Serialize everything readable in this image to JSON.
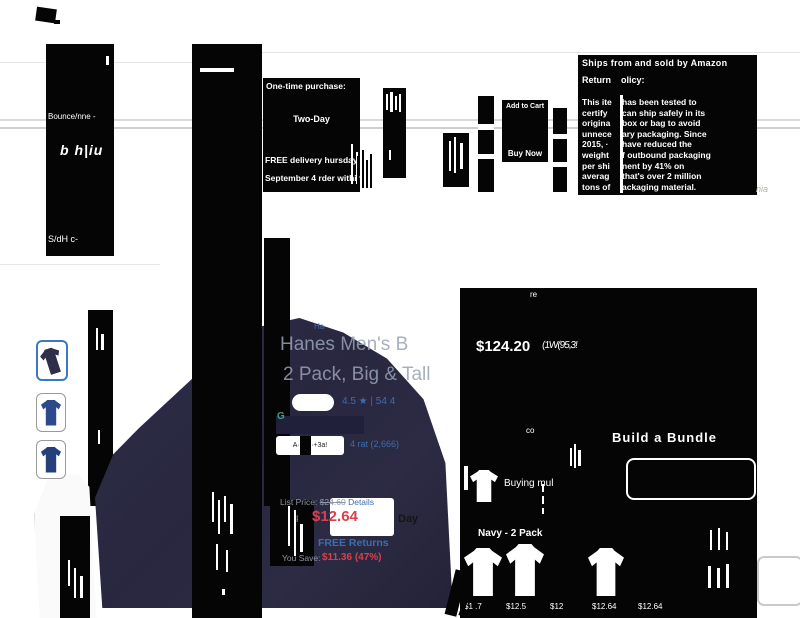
{
  "artifacts": {
    "left_block": {
      "frag1": "Bounce/nne -",
      "frag2": "b h|iu",
      "frag3": "S/dH c-"
    },
    "handwriting_note": "nia",
    "mini_mark": "Ha"
  },
  "purchase_box": {
    "title": "One-time purchase:",
    "shipping_speed": "Two-Day",
    "delivery_line1": "FREE delivery  hursday,",
    "delivery_line2": "September 4  rder within"
  },
  "cart": {
    "add_to_cart": "Add to Cart",
    "buy_now": "Buy Now"
  },
  "shipping_panel": {
    "ships_from": "Ships from and sold by Amazon",
    "return_word": "Return",
    "policy_word": "olicy:",
    "left_col": {
      "0": "This ite",
      "1": "certify",
      "2": "origina",
      "3": "unnece",
      "4": "2015, ·",
      "5": "weight",
      "6": "per shi",
      "7": "averag",
      "8": "tons of"
    },
    "right_col": {
      "0": "has been tested to",
      "1": "can ship safely in its",
      "2": "box or bag to avoid",
      "3": "ary packaging. Since",
      "4": "have reduced the",
      "5": "f outbound packaging",
      "6": "nent by 41% on",
      "7": "that's over 2 million",
      "8": "ackaging material."
    }
  },
  "product": {
    "title_line1": "Hanes Men's B",
    "title_line2": "2 Pack, Big & Tall",
    "rating_text": "4.5 ★ | 54 4",
    "green_mark": "G",
    "badge_pill": "A· BA·+3a!",
    "badge_link": "4 rat (2,666)"
  },
  "pricing": {
    "list_label": "List Price:",
    "list_price": "$24.60",
    "details_link": "Details",
    "price_label": "P",
    "price": "$12.64",
    "day_text": "Day",
    "free_returns": "FREE Returns",
    "save_label": "You Save:",
    "save_value": "$11.36 (47%)"
  },
  "buy_panel": {
    "re_text": "re",
    "price_big": "$124.20",
    "price_noise": "(1W(95,3!",
    "co_text": "co",
    "bundle_title": "Build a Bundle",
    "buying_text": "Buying mul",
    "variant_label": "Navy - 2 Pack",
    "swatch_prices": {
      "0": "$1 .7",
      "1": "$12.5",
      "2": "$12",
      "3": "$12.64",
      "4": "$12.64"
    }
  },
  "colors": {
    "accent_blue": "#3b6db0",
    "price_red": "#d8404e",
    "navy_shirt": "#2a2940"
  }
}
